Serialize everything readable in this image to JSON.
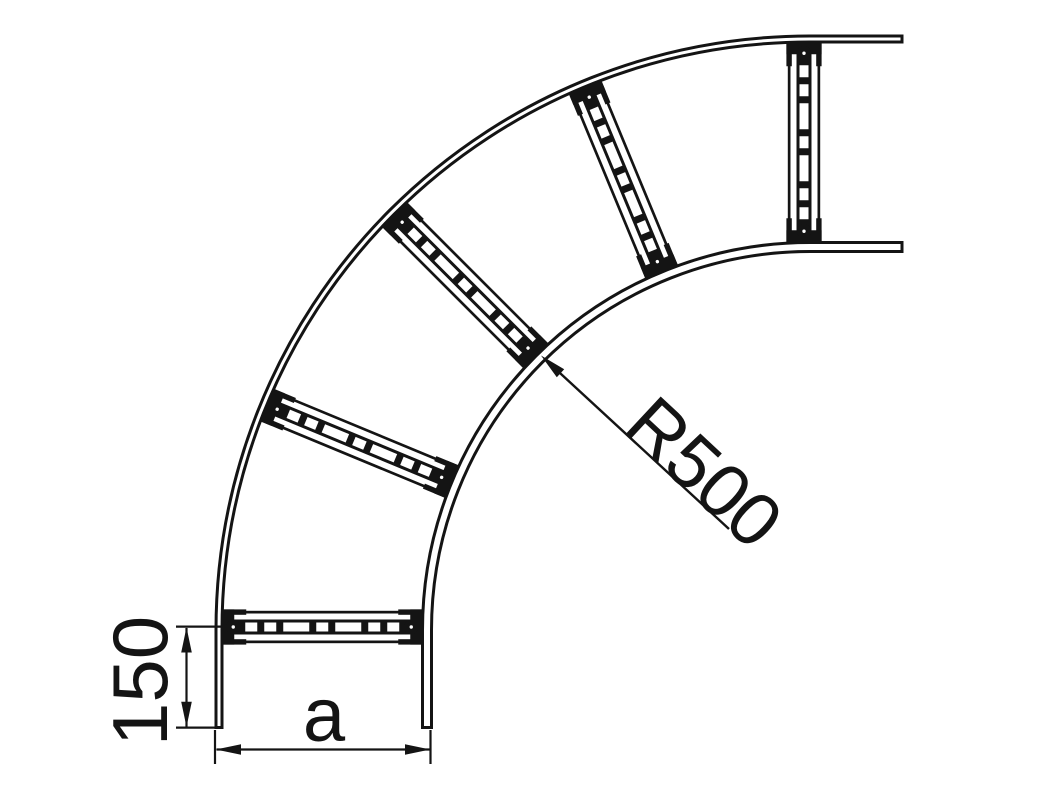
{
  "drawing": {
    "kind": "cable-ladder-90-degree-bend-plan-view",
    "labels": {
      "radius": "R500",
      "tangent_length": "150",
      "width": "a"
    },
    "colors": {
      "ink": "#141414",
      "background": "#ffffff"
    },
    "structure": {
      "rung_count": 5,
      "bend_angle_deg": 90
    }
  }
}
